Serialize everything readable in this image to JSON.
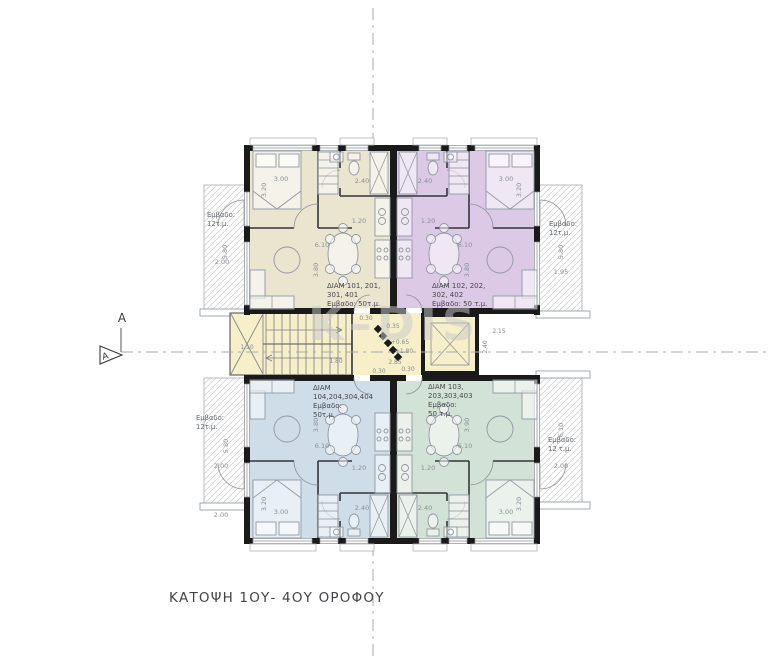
{
  "title": "ΚΑΤΟΨΗ 1ΟΥ- 4ΟΥ ΟΡΟΦΟΥ",
  "watermark": "K–DIS",
  "section": {
    "letter": "A"
  },
  "apartments": {
    "a101": {
      "l1": "ΔΙΑΜ 101, 201,",
      "l2": "301, 401",
      "l3": "Εμβαδο: 50τ.μ."
    },
    "a102": {
      "l1": "ΔΙΑΜ 102, 202,",
      "l2": "302, 402",
      "l3": "Εμβαδο: 50 τ.μ."
    },
    "a103": {
      "l1": "ΔΙΑΜ 103,",
      "l2": "203,303,403",
      "l3": "Εμβαδο:",
      "l4": "50 τ.μ."
    },
    "a104": {
      "l1": "ΔΙΑΜ",
      "l2": "104,204,304,404",
      "l3": "Εμβαδο:",
      "l4": "50τ.μ."
    }
  },
  "balconies": {
    "tl": {
      "l1": "Εμβαδο:",
      "l2": "12τ.μ."
    },
    "tr": {
      "l1": "Εμβαδο:",
      "l2": "12τ.μ."
    },
    "bl": {
      "l1": "Εμβαδο:",
      "l2": "12τ.μ."
    },
    "br": {
      "l1": "Εμβαδο:",
      "l2": "12 τ.μ."
    }
  },
  "dims": {
    "w300": "3.00",
    "w320": "3.20",
    "w240": "2.40",
    "w120": "1.20",
    "w610": "6.10",
    "w380": "3.80",
    "w390": "3.90",
    "w580": "5.80",
    "w200": "2.00",
    "w195": "1.95",
    "w110": "1.10",
    "w180": "1.80",
    "w030": "0.30",
    "w035": "0.35",
    "lvl065": "+0.65",
    "lvl180": "+1.80",
    "w285": "2.85",
    "w215": "2.15",
    "w240v": "2.40"
  },
  "colors": {
    "apt101": "#e9e5cf",
    "apt102": "#dcc9e6",
    "apt103": "#d3e2d6",
    "apt104": "#cfdde9",
    "core": "#f6efc9",
    "wall": "#1a1a1a",
    "dimText": "#8a8f96",
    "centerline": "#a6a9ad",
    "watermark": "#c9c9c9",
    "title": "#434347"
  }
}
